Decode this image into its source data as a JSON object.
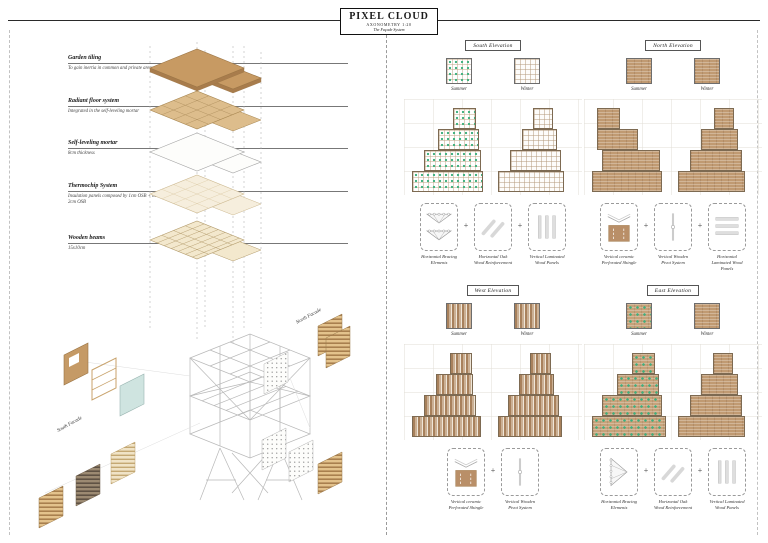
{
  "title": {
    "main": "PIXEL CLOUD",
    "subtitle": "AXONOMETRY 1:20",
    "tagline": "The Façade System"
  },
  "ui": {
    "plus": "+"
  },
  "colors": {
    "wood_brown": "#c59a66",
    "tile_tan": "#ddbd8c",
    "plant_green": "#46b283",
    "shingle_tan": "#c09a72",
    "glass_blue": "#cfe4e0",
    "structure_gray": "#b8b8b8"
  },
  "axonometric": {
    "layer_labels": [
      {
        "name": "Garden tiling",
        "desc": "To gain inertia in common and private areas"
      },
      {
        "name": "Radiant floor system",
        "desc": "Integrated in the self-leveling mortar"
      },
      {
        "name": "Self-leveling mortar",
        "desc": "8cm thickness"
      },
      {
        "name": "Thermochip System",
        "desc": "Insulation panels composed by 1cm OSB + 8cm Cork Insulation + 2cm OSB"
      },
      {
        "name": "Wooden beams",
        "desc": "15x10cm"
      }
    ],
    "facade_labels": {
      "south": "South Facade",
      "north": "North Facade"
    }
  },
  "elevations": [
    {
      "id": "south",
      "title": "South Elevation",
      "seasons": [
        {
          "label": "Summer",
          "texture": "green-grid"
        },
        {
          "label": "Winter",
          "texture": "plain-grid"
        }
      ],
      "stacks": {
        "summer": [
          [
            1.8,
            1.0
          ],
          [
            1.15,
            1.75
          ],
          [
            0.5,
            2.5
          ],
          [
            0,
            3.1
          ]
        ],
        "winter": [
          [
            1.5,
            0.9
          ],
          [
            1.05,
            1.5
          ],
          [
            0.5,
            2.25
          ],
          [
            0,
            2.85
          ]
        ]
      },
      "components": [
        {
          "icon": "truss-icon",
          "label": "Horizontal Bracing Elements"
        },
        {
          "icon": "diagonals-icon",
          "label": "Horizontal Oak Wood Reinforcement"
        },
        {
          "icon": "vbars-icon",
          "label": "Vertical Laminated Wood Panels"
        }
      ]
    },
    {
      "id": "north",
      "title": "North Elevation",
      "seasons": [
        {
          "label": "Summer",
          "texture": "shingle"
        },
        {
          "label": "Winter",
          "texture": "shingle"
        }
      ],
      "stacks": {
        "summer": [
          [
            0.2,
            1.0
          ],
          [
            0.2,
            1.8
          ],
          [
            0.45,
            2.5
          ],
          [
            0,
            3.05
          ]
        ],
        "winter": [
          [
            1.55,
            0.9
          ],
          [
            1.0,
            1.6
          ],
          [
            0.5,
            2.3
          ],
          [
            0,
            2.9
          ]
        ]
      },
      "components": [
        {
          "icon": "shingle-v-icon",
          "label": "Vertical ceramic Perforated Shingle"
        },
        {
          "icon": "pivot-icon",
          "label": "Vertical Wooden Pivot System"
        },
        {
          "icon": "hbars-icon",
          "label": "Horizontal Laminated Wood Panels"
        }
      ]
    },
    {
      "id": "west",
      "title": "West Elevation",
      "seasons": [
        {
          "label": "Summer",
          "texture": "stripes"
        },
        {
          "label": "Winter",
          "texture": "stripes"
        }
      ],
      "stacks": {
        "summer": [
          [
            1.65,
            0.95
          ],
          [
            1.05,
            1.6
          ],
          [
            0.5,
            2.3
          ],
          [
            0,
            3.0
          ]
        ],
        "winter": [
          [
            1.4,
            0.9
          ],
          [
            0.9,
            1.55
          ],
          [
            0.45,
            2.2
          ],
          [
            0,
            2.8
          ]
        ]
      },
      "components": [
        {
          "icon": "shingle-v-icon",
          "label": "Vertical ceramic Perforated Shingle"
        },
        {
          "icon": "pivot-icon",
          "label": "Vertical Wooden Pivot System"
        }
      ]
    },
    {
      "id": "east",
      "title": "East Elevation",
      "seasons": [
        {
          "label": "Summer",
          "texture": "green-shingle"
        },
        {
          "label": "Winter",
          "texture": "shingle"
        }
      ],
      "stacks": {
        "summer": [
          [
            1.75,
            1.0
          ],
          [
            1.1,
            1.8
          ],
          [
            0.45,
            2.6
          ],
          [
            0,
            3.2
          ]
        ],
        "winter": [
          [
            1.5,
            0.9
          ],
          [
            1.0,
            1.6
          ],
          [
            0.5,
            2.3
          ],
          [
            0,
            2.9
          ]
        ]
      },
      "components": [
        {
          "icon": "truss-v-icon",
          "label": "Horizontal Bracing Elements"
        },
        {
          "icon": "diagonals-icon",
          "label": "Horizontal Oak Wood Reinforcement"
        },
        {
          "icon": "vbars-icon",
          "label": "Vertical Laminated Wood Panels"
        }
      ]
    }
  ]
}
